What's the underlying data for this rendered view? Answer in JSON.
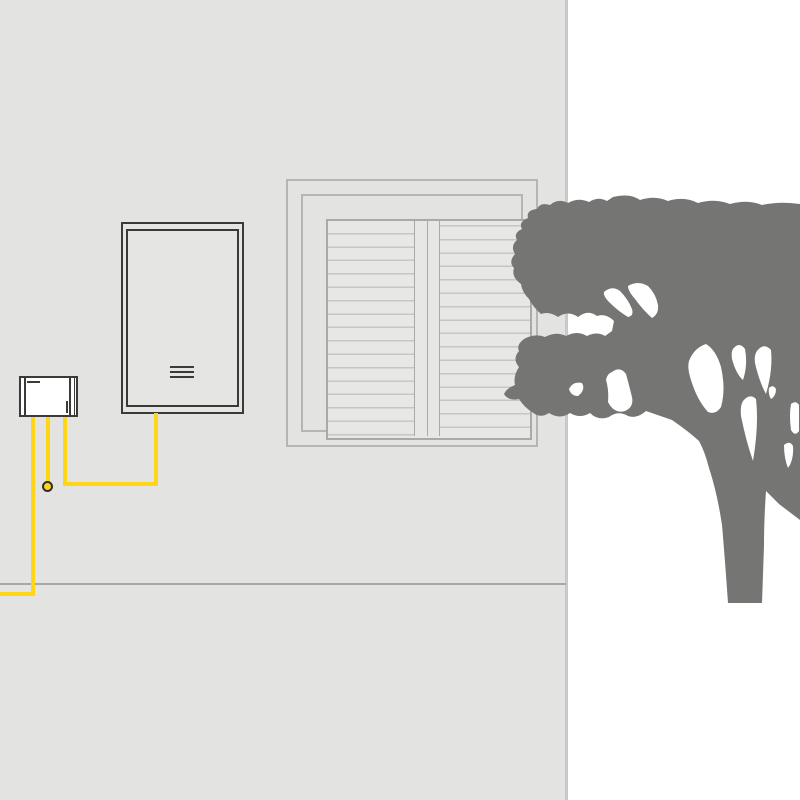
{
  "title": "House wall with solar inverter, energy meter, shuttered window and tree",
  "colors": {
    "background": "#ffffff",
    "wall": "#e3e3e2",
    "wall_edge": "#c9c9c8",
    "ground_line": "#a9a8a7",
    "window_frame": "#b5b5b4",
    "window_panel_border": "#a9a9a8",
    "panel_fill": "#e7e7e6",
    "louver_line": "#c6c6c5",
    "device_stroke": "#3a3a39",
    "device_fill_inverter": "#e5e5e4",
    "device_fill_meter": "#ffffff",
    "cable": "#ffd617",
    "node_ring": "#2e2e2d",
    "tree": "#757574"
  },
  "scene": {
    "wall": {
      "name": "house wall",
      "width_px": 566
    },
    "ground": {
      "name": "ground line",
      "y_px": 583
    },
    "window": {
      "name": "window with closed louvered shutters",
      "shutter_count": 2,
      "louvers_per_shutter": 16
    },
    "inverter": {
      "name": "wall-mounted solar inverter",
      "vent_slots": 3
    },
    "meter": {
      "name": "energy meter connection box"
    },
    "cables": {
      "name": "yellow AC cables",
      "count_from_meter": 3,
      "junction_nodes": 1,
      "routes": [
        "meter to left image edge along ground",
        "meter to terminal node",
        "meter to inverter via horizontal junction"
      ]
    },
    "tree": {
      "name": "tree silhouette",
      "trunk_bottom_y_px": 603
    }
  }
}
